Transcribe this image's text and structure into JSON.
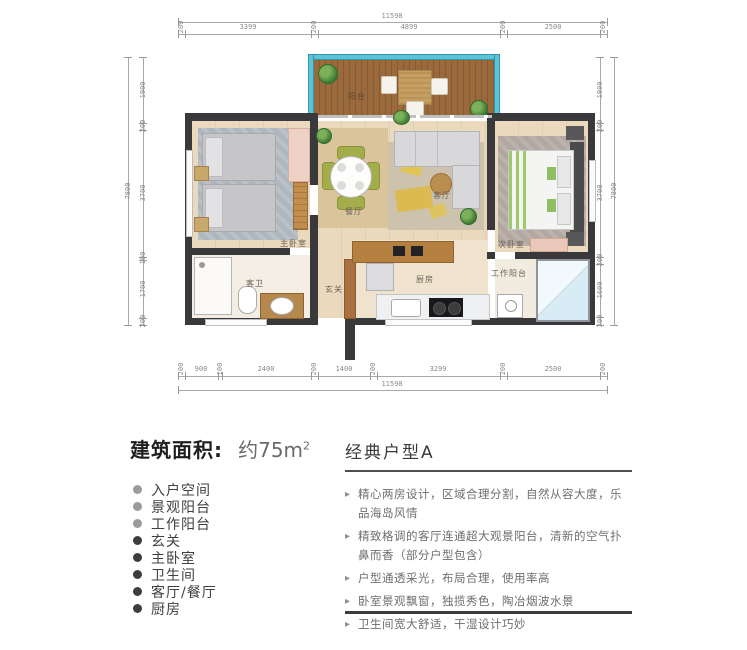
{
  "plan": {
    "dims": {
      "top_total": "11598",
      "bottom_total": "11598",
      "left_total": "7800",
      "right_total": "7800",
      "top_segments": [
        "200",
        "3399",
        "200",
        "4899",
        "200",
        "2500",
        "200"
      ],
      "bottom_segments": [
        "200",
        "900",
        "100",
        "2400",
        "200",
        "1400",
        "200",
        "3299",
        "200",
        "2500",
        "200"
      ],
      "left_segments": [
        "1900",
        "200",
        "3700",
        "100",
        "1700",
        "200"
      ],
      "right_segments": [
        "1900",
        "200",
        "3700",
        "200",
        "1600",
        "200"
      ]
    },
    "labels": {
      "balcony": "阳台",
      "master_bedroom": "主卧室",
      "bathroom": "客卫",
      "dining": "餐厅",
      "living": "客厅",
      "second_bedroom": "次卧室",
      "entry": "玄关",
      "kitchen": "厨房",
      "work_balcony": "工作阳台"
    },
    "colors": {
      "wall": "#39393b",
      "glass_rail": "#5fc3d6",
      "wood_deck": "#96683c",
      "floor": "#ead9bd"
    }
  },
  "info": {
    "area_label": "建筑面积:",
    "area_value": "约75m",
    "area_sup": "2",
    "rooms": [
      "入户空间",
      "景观阳台",
      "工作阳台",
      "玄关",
      "主卧室",
      "卫生间",
      "客厅/餐厅",
      "厨房"
    ],
    "type_title": "经典户型A",
    "bullet_icon": "▸",
    "features": [
      "精心两房设计，区域合理分割，自然从容大度，乐品海岛风情",
      "精致格调的客厅连通超大观景阳台，清新的空气扑鼻而香（部分户型包含）",
      "户型通透采光，布局合理，使用率高",
      "卧室景观飘窗，独揽秀色，陶冶烟波水景",
      "卫生间宽大舒适，干湿设计巧妙"
    ]
  }
}
